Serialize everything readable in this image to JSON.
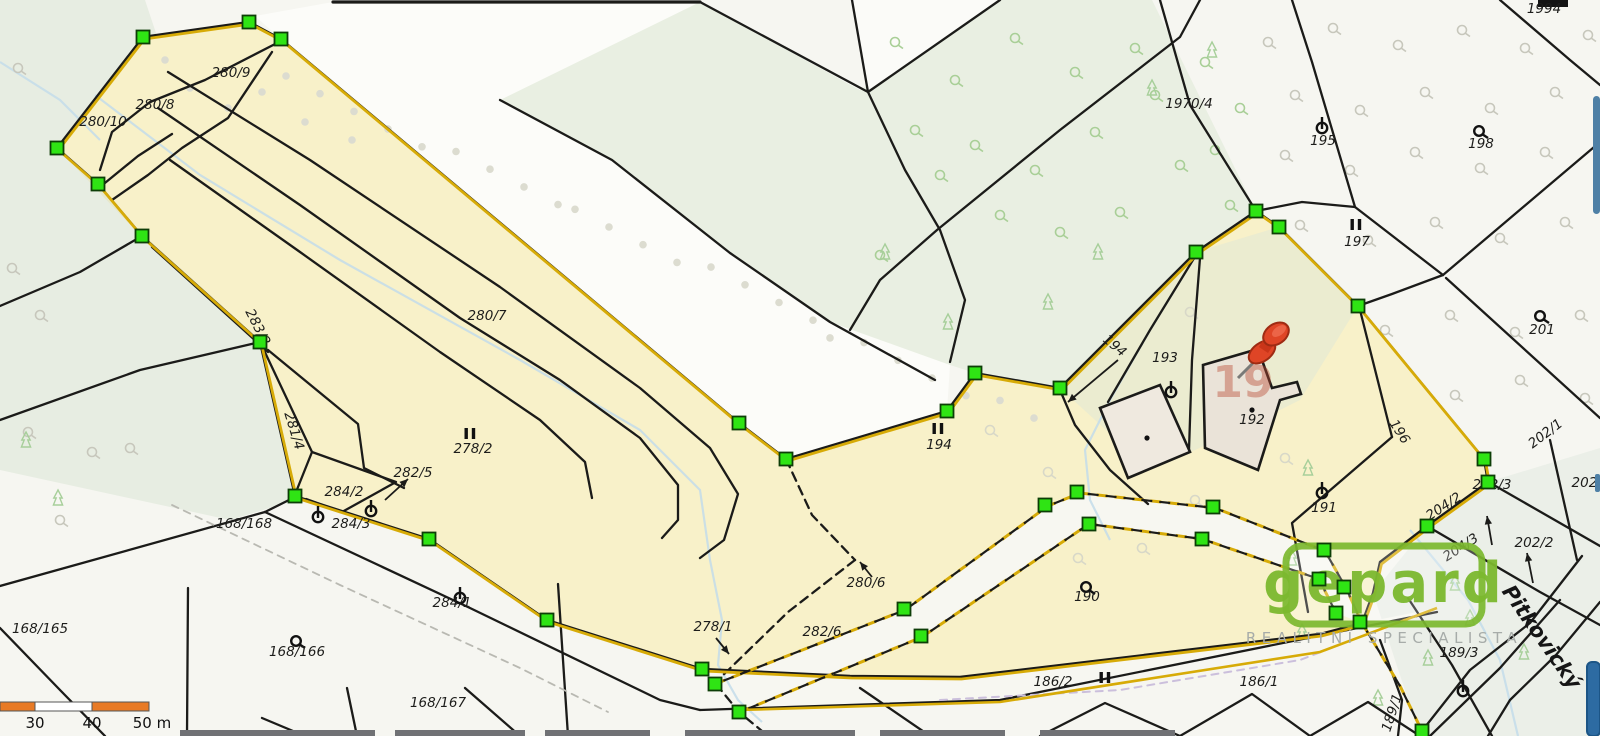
{
  "map": {
    "title": "cadastral-parcel-map",
    "colors": {
      "selection_fill": "#f8f1c9",
      "selection_outline": "#d7ab07",
      "vertex_green": "#2fe414",
      "pin_red": "#df4526",
      "logo_green": "#7cb92f",
      "scale_orange": "#e87a25",
      "stream_blue": "#c3dcea"
    },
    "parcel_labels": [
      {
        "text": "280/9",
        "x": 231,
        "y": 77
      },
      {
        "text": "280/8",
        "x": 155,
        "y": 109
      },
      {
        "text": "280/10",
        "x": 103,
        "y": 126
      },
      {
        "text": "283/2",
        "x": 254,
        "y": 329,
        "rot": 63
      },
      {
        "text": "281/4",
        "x": 290,
        "y": 432,
        "rot": 73
      },
      {
        "text": "280/7",
        "x": 487,
        "y": 320
      },
      {
        "text": "278/2",
        "x": 473,
        "y": 453
      },
      {
        "text": "282/5",
        "x": 413,
        "y": 477
      },
      {
        "text": "284/2",
        "x": 344,
        "y": 496
      },
      {
        "text": "284/3",
        "x": 351,
        "y": 528
      },
      {
        "text": "168/168",
        "x": 244,
        "y": 528
      },
      {
        "text": "284/1",
        "x": 452,
        "y": 607
      },
      {
        "text": "168/165",
        "x": 40,
        "y": 633
      },
      {
        "text": "168/166",
        "x": 297,
        "y": 656
      },
      {
        "text": "168/167",
        "x": 438,
        "y": 707
      },
      {
        "text": "278/1",
        "x": 713,
        "y": 631
      },
      {
        "text": "280/6",
        "x": 866,
        "y": 587
      },
      {
        "text": "282/6",
        "x": 822,
        "y": 636
      },
      {
        "text": "186/2",
        "x": 1053,
        "y": 686
      },
      {
        "text": "186/1",
        "x": 1259,
        "y": 686
      },
      {
        "text": "190",
        "x": 1087,
        "y": 601
      },
      {
        "text": "191",
        "x": 1324,
        "y": 512
      },
      {
        "text": "192",
        "x": 1252,
        "y": 424
      },
      {
        "text": "193",
        "x": 1165,
        "y": 362
      },
      {
        "text": "194",
        "x": 939,
        "y": 449
      },
      {
        "text": "194",
        "x": 1112,
        "y": 349,
        "rot": 40,
        "size": 10.5
      },
      {
        "text": "195",
        "x": 1323,
        "y": 145
      },
      {
        "text": "197",
        "x": 1357,
        "y": 246
      },
      {
        "text": "198",
        "x": 1481,
        "y": 148
      },
      {
        "text": "201",
        "x": 1542,
        "y": 334
      },
      {
        "text": "1970/4",
        "x": 1189,
        "y": 108
      },
      {
        "text": "1994",
        "x": 1544,
        "y": 13
      },
      {
        "text": "196",
        "x": 1396,
        "y": 434,
        "rot": 57
      },
      {
        "text": "202/1",
        "x": 1548,
        "y": 437,
        "rot": -37
      },
      {
        "text": "202/3",
        "x": 1492,
        "y": 489
      },
      {
        "text": "202/5",
        "x": 1591,
        "y": 487
      },
      {
        "text": "202/2",
        "x": 1534,
        "y": 547
      },
      {
        "text": "204/2",
        "x": 1446,
        "y": 510,
        "rot": -33
      },
      {
        "text": "204/3",
        "x": 1463,
        "y": 551,
        "rot": -33
      },
      {
        "text": "189/1",
        "x": 1396,
        "y": 714,
        "rot": -72
      },
      {
        "text": "189/3",
        "x": 1459,
        "y": 657,
        "size": 11,
        "color": "#97a097"
      }
    ],
    "street_label": {
      "text": "Pitkovický",
      "x": 1536,
      "y": 641,
      "rot": 55
    },
    "house_number": {
      "text": "19",
      "x": 1243,
      "y": 397,
      "color": "#b94a33"
    },
    "land_use_symbols": [
      {
        "type": "theta",
        "x": 318,
        "y": 516
      },
      {
        "type": "theta",
        "x": 371,
        "y": 510
      },
      {
        "type": "theta",
        "x": 460,
        "y": 597
      },
      {
        "type": "theta",
        "x": 1171,
        "y": 391
      },
      {
        "type": "theta",
        "x": 1322,
        "y": 127
      },
      {
        "type": "theta",
        "x": 1322,
        "y": 492
      },
      {
        "type": "theta",
        "x": 1463,
        "y": 690
      },
      {
        "type": "q",
        "x": 296,
        "y": 641
      },
      {
        "type": "q",
        "x": 1086,
        "y": 587
      },
      {
        "type": "q",
        "x": 1479,
        "y": 131
      },
      {
        "type": "q",
        "x": 1540,
        "y": 316
      },
      {
        "type": "ii",
        "x": 470,
        "y": 437
      },
      {
        "type": "ii",
        "x": 938,
        "y": 432
      },
      {
        "type": "ii",
        "x": 1356,
        "y": 228
      },
      {
        "type": "ii",
        "x": 1105,
        "y": 681
      },
      {
        "type": "dot",
        "x": 1252,
        "y": 410
      },
      {
        "type": "dot",
        "x": 1147,
        "y": 438
      }
    ],
    "selection_vertices": [
      [
        143,
        37
      ],
      [
        249,
        22
      ],
      [
        281,
        39
      ],
      [
        57,
        148
      ],
      [
        98,
        184
      ],
      [
        142,
        236
      ],
      [
        260,
        342
      ],
      [
        295,
        496
      ],
      [
        429,
        539
      ],
      [
        547,
        620
      ],
      [
        702,
        669
      ],
      [
        739,
        423
      ],
      [
        786,
        459
      ],
      [
        947,
        411
      ],
      [
        975,
        373
      ],
      [
        1060,
        388
      ],
      [
        1196,
        252
      ],
      [
        1256,
        211
      ],
      [
        1279,
        227
      ],
      [
        1358,
        306
      ],
      [
        1484,
        459
      ],
      [
        1488,
        482
      ],
      [
        1427,
        526
      ],
      [
        904,
        609
      ],
      [
        921,
        636
      ],
      [
        1045,
        505
      ],
      [
        1077,
        492
      ],
      [
        1089,
        524
      ],
      [
        1213,
        507
      ],
      [
        1202,
        539
      ],
      [
        1324,
        550
      ],
      [
        1319,
        579
      ],
      [
        1344,
        587
      ],
      [
        1336,
        613
      ],
      [
        1360,
        622
      ],
      [
        715,
        684
      ],
      [
        739,
        712
      ],
      [
        1422,
        731
      ]
    ],
    "scale_bar": {
      "labels": [
        {
          "text": "30",
          "x": 35
        },
        {
          "text": "40",
          "x": 92
        },
        {
          "text": "50 m",
          "x": 152
        }
      ]
    },
    "watermark": {
      "title": "gepard",
      "subtitle": "REALITNÍ SPECIALISTA"
    }
  }
}
